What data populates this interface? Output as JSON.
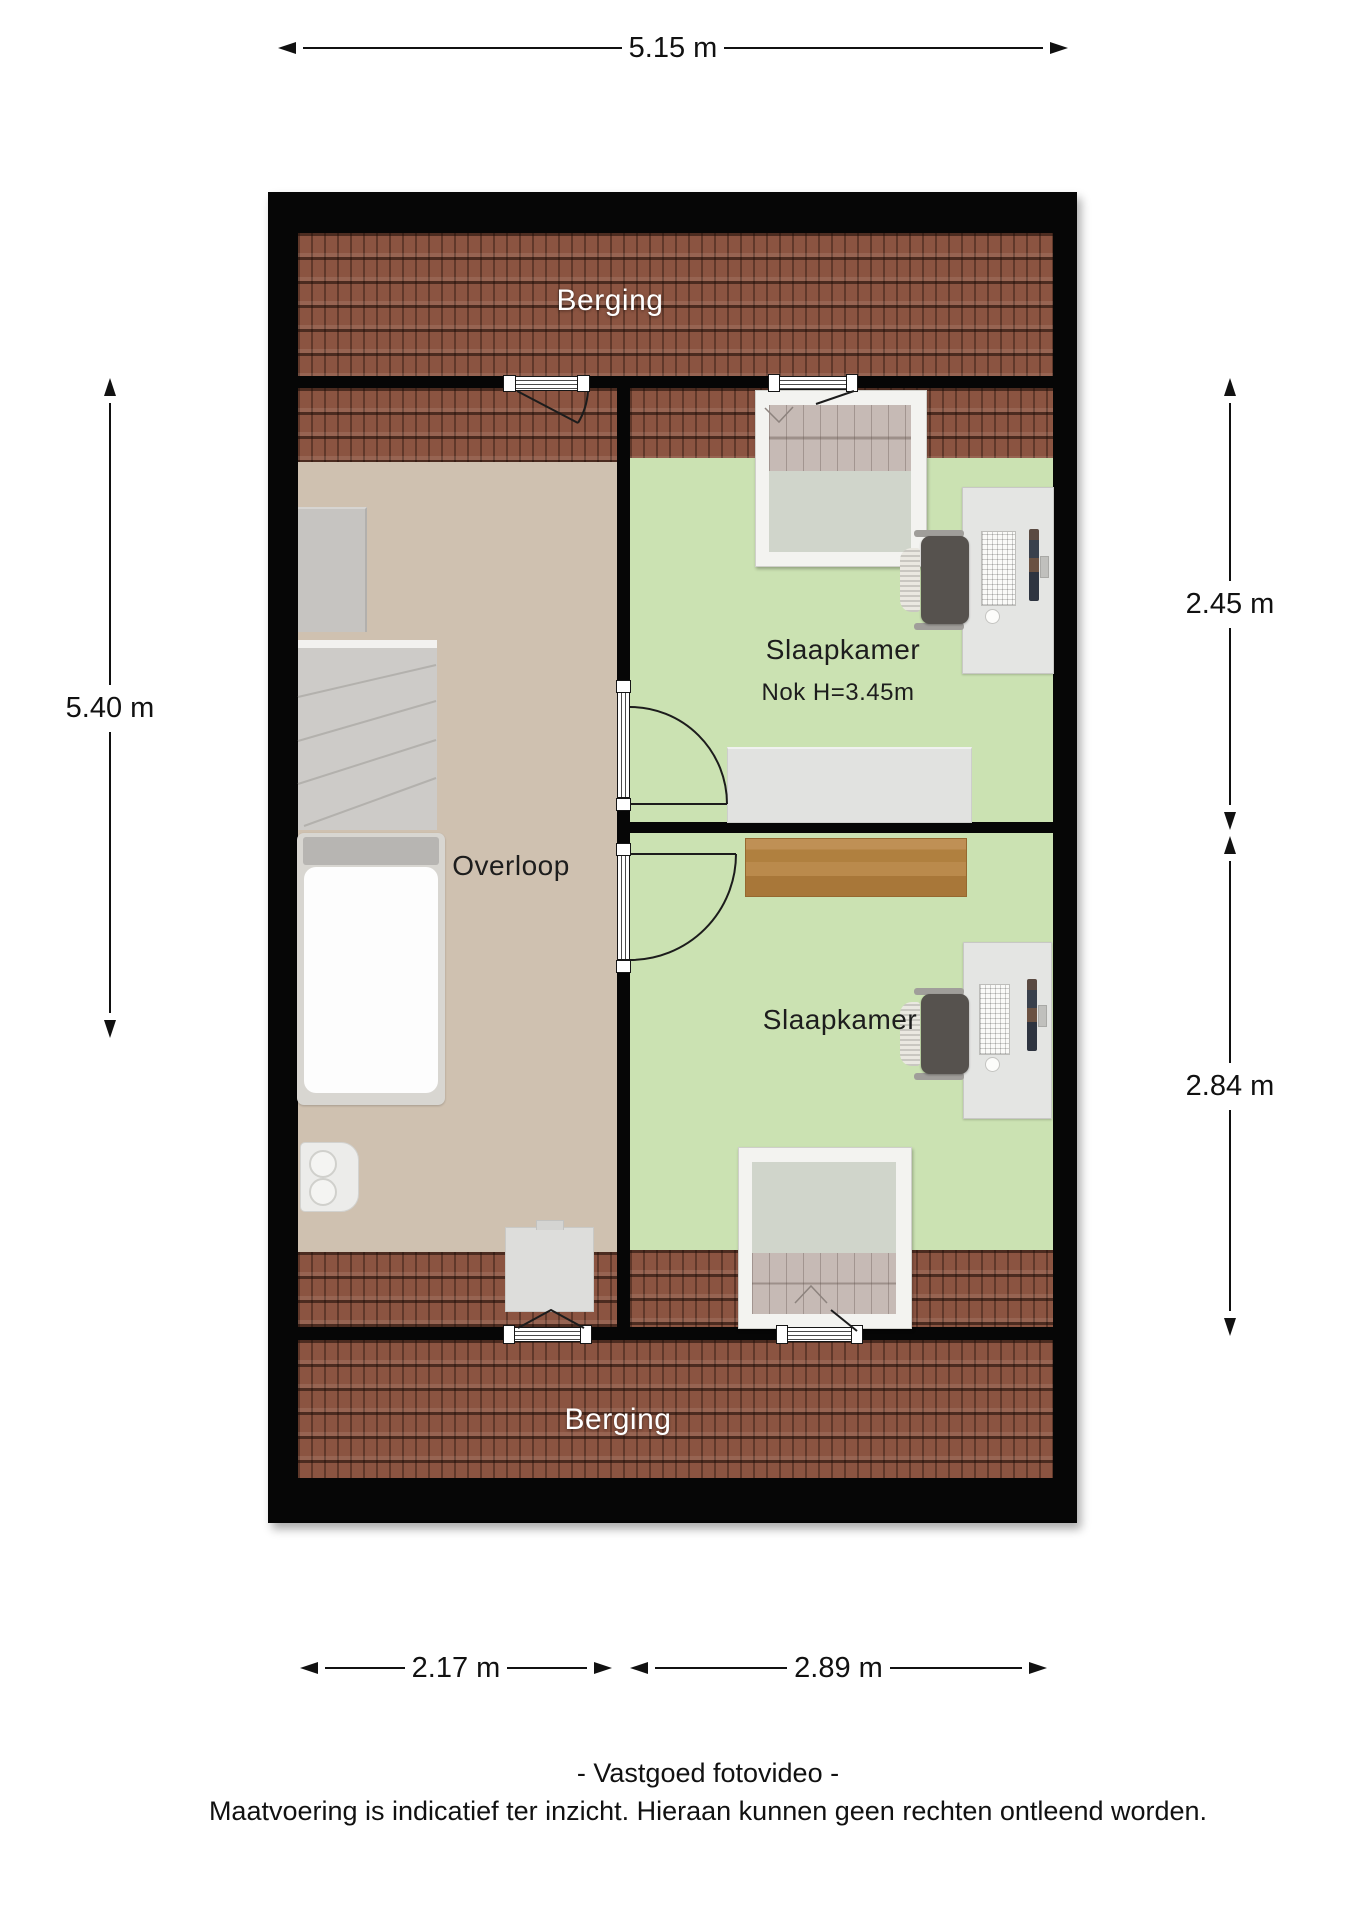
{
  "plan": {
    "labels": {
      "berging_top": "Berging",
      "berging_bottom": "Berging",
      "overloop": "Overloop",
      "slaapkamer_top": "Slaapkamer",
      "slaapkamer_top_note": "Nok H=3.45m",
      "slaapkamer_bottom": "Slaapkamer"
    },
    "colors": {
      "wall": "#060606",
      "roof_tiles": "#8b5441",
      "floor_landing": "#cfc1b0",
      "floor_bedroom": "#cbe2b2",
      "wood_furniture": "#b5854f",
      "dormer_frame": "#f3f3f0"
    }
  },
  "dimensions": {
    "top": "5.15 m",
    "left": "5.40 m",
    "right_upper": "2.45 m",
    "right_lower": "2.84 m",
    "bottom_left": "2.17 m",
    "bottom_right": "2.89 m"
  },
  "footer": {
    "line1": "- Vastgoed fotovideo -",
    "line2": "Maatvoering is indicatief ter inzicht. Hieraan kunnen geen rechten ontleend worden."
  }
}
